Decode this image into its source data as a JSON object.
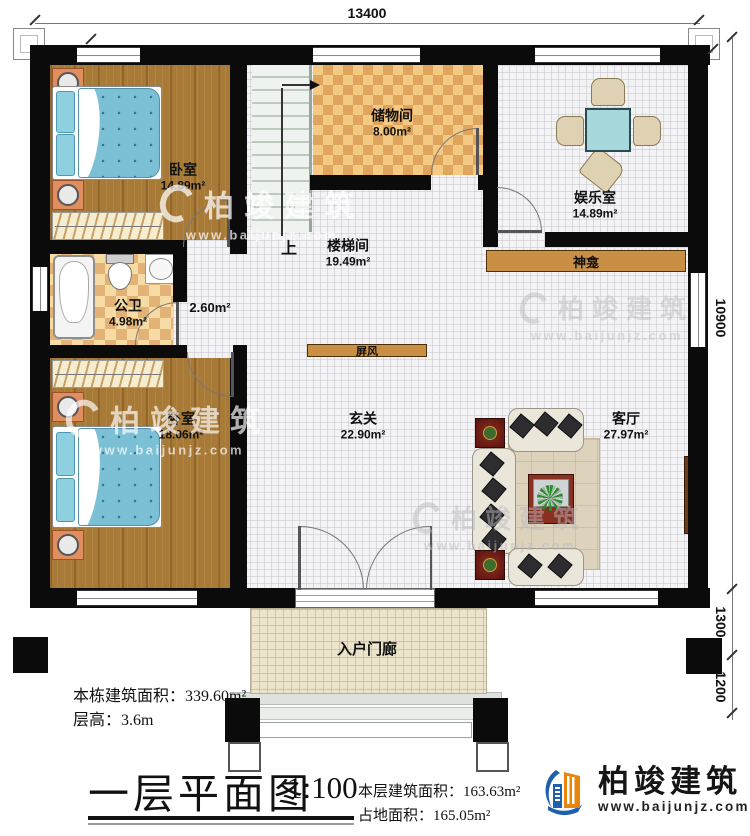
{
  "title": {
    "text": "一层平面图",
    "scale": "1:100"
  },
  "dimensions": {
    "top": "13400",
    "right_upper": "10900",
    "right_mid": "1300",
    "right_lower": "1200"
  },
  "rooms": {
    "bedroom1": {
      "name": "卧室",
      "area": "14.89m²"
    },
    "storage": {
      "name": "储物间",
      "area": "8.00m²"
    },
    "entertainment": {
      "name": "娱乐室",
      "area": "14.89m²"
    },
    "stairwell": {
      "name": "楼梯间",
      "area": "19.49m²"
    },
    "bathroom": {
      "name": "公卫",
      "area": "4.98m²"
    },
    "corridor": {
      "area": "2.60m²"
    },
    "bedroom2": {
      "name": "卧室",
      "area": "18.06m²"
    },
    "foyer": {
      "name": "玄关",
      "area": "22.90m²"
    },
    "living": {
      "name": "客厅",
      "area": "27.97m²"
    },
    "porch": {
      "name": "入户门廊"
    }
  },
  "features": {
    "shrine": "神龛",
    "screen": "屏风",
    "stairs_up": "上"
  },
  "stats": {
    "building_area": {
      "label": "本栋建筑面积：",
      "value": "339.60m²"
    },
    "floor_height": {
      "label": "层高：",
      "value": "3.6m"
    },
    "floor_area": {
      "label": "本层建筑面积：",
      "value": "163.63m²"
    },
    "footprint": {
      "label": "占地面积：",
      "value": "165.05m²"
    }
  },
  "brand": {
    "name": "柏竣建筑",
    "website": "www.baijunjz.com"
  },
  "watermark": {
    "name": "柏竣建筑",
    "website": "www.baijunjz.com"
  }
}
